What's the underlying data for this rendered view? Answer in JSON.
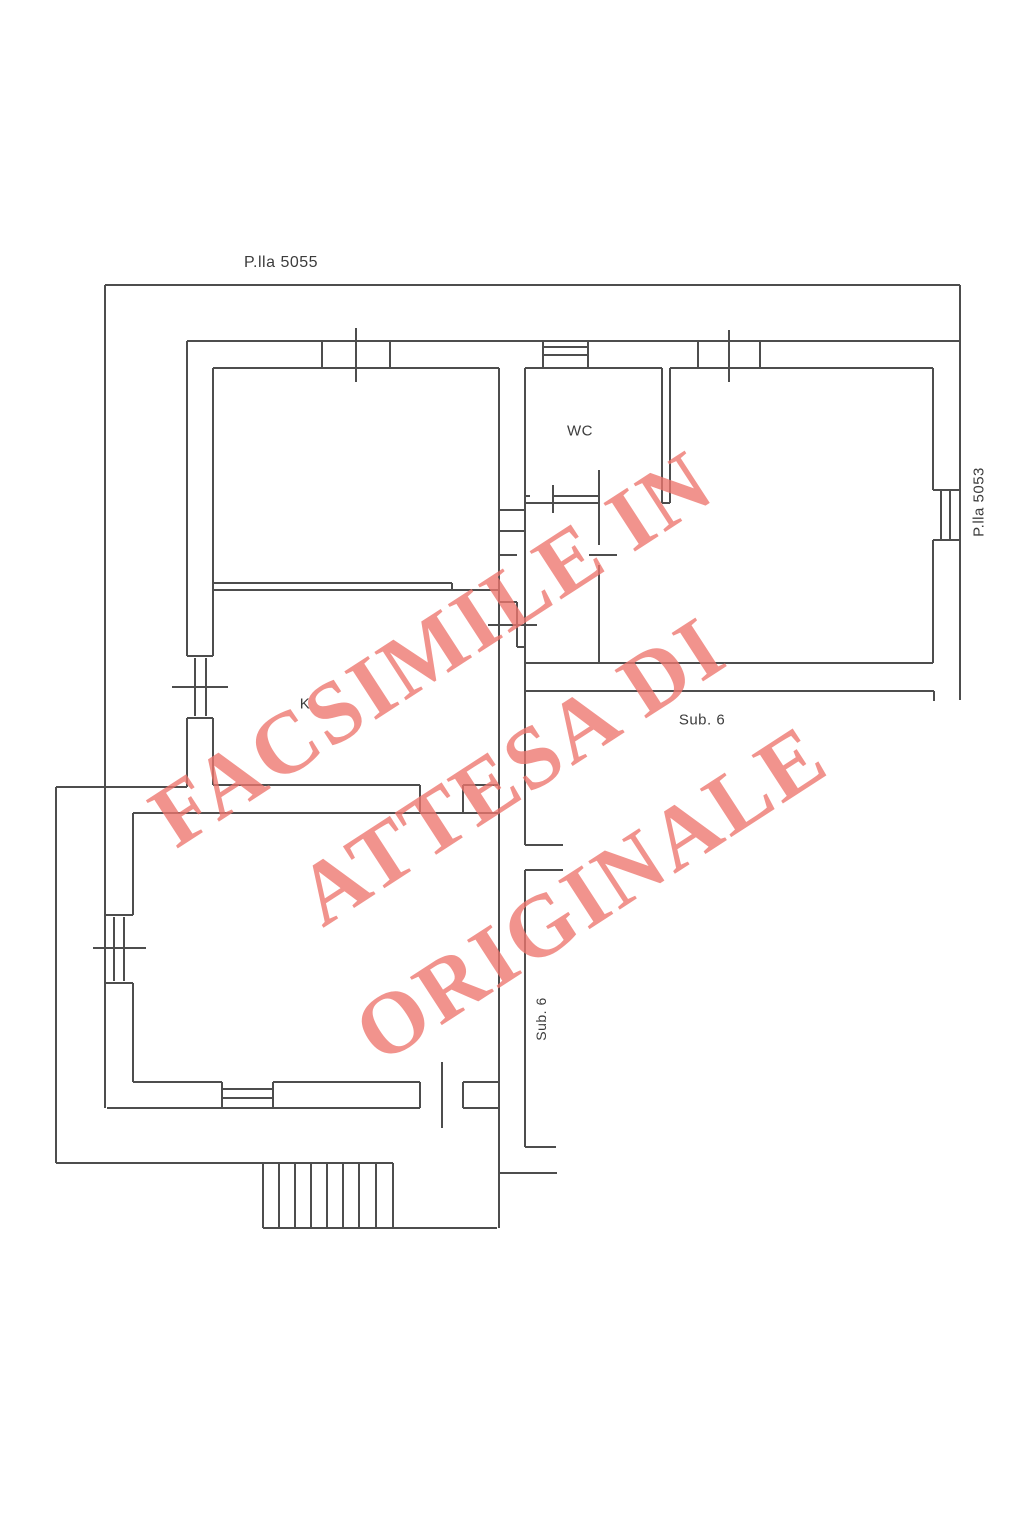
{
  "page": {
    "width": 1023,
    "height": 1535,
    "background": "#ffffff"
  },
  "plan": {
    "stroke": "#4d4d4d",
    "stroke_width": 2,
    "labels": [
      {
        "id": "parcel-label-5055",
        "text": "P.lla 5055",
        "cx": 281,
        "cy": 263,
        "size": 16,
        "rot": 0
      },
      {
        "id": "parcel-label-5053",
        "text": "P.lla 5053",
        "cx": 979,
        "cy": 502,
        "size": 15,
        "rot": -90
      },
      {
        "id": "room-label-wc",
        "text": "WC",
        "cx": 580,
        "cy": 431,
        "size": 15,
        "rot": 0
      },
      {
        "id": "room-label-k",
        "text": "K",
        "cx": 305,
        "cy": 704,
        "size": 15,
        "rot": 0
      },
      {
        "id": "area-label-sub6",
        "text": "Sub. 6",
        "cx": 702,
        "cy": 720,
        "size": 15,
        "rot": 0
      },
      {
        "id": "area-label-sub6-vertical",
        "text": "Sub. 6",
        "cx": 541,
        "cy": 1019,
        "size": 14,
        "rot": -90
      }
    ],
    "segments": [
      [
        105,
        285,
        960,
        285
      ],
      [
        960,
        285,
        960,
        700
      ],
      [
        105,
        285,
        105,
        1108
      ],
      [
        56,
        787,
        187,
        787
      ],
      [
        56,
        787,
        56,
        1163
      ],
      [
        56,
        1163,
        393,
        1163
      ],
      [
        107,
        1108,
        420,
        1108
      ],
      [
        463,
        1108,
        499,
        1108
      ],
      [
        187,
        341,
        960,
        341
      ],
      [
        322,
        341,
        322,
        368
      ],
      [
        390,
        341,
        390,
        368
      ],
      [
        356,
        328,
        356,
        382
      ],
      [
        543,
        341,
        543,
        368
      ],
      [
        588,
        341,
        588,
        368
      ],
      [
        543,
        347,
        588,
        347
      ],
      [
        543,
        355,
        588,
        355
      ],
      [
        698,
        341,
        698,
        368
      ],
      [
        760,
        341,
        760,
        368
      ],
      [
        729,
        330,
        729,
        382
      ],
      [
        187,
        341,
        187,
        656
      ],
      [
        187,
        718,
        187,
        787
      ],
      [
        187,
        656,
        213,
        656
      ],
      [
        187,
        718,
        213,
        718
      ],
      [
        195,
        658,
        195,
        716
      ],
      [
        206,
        658,
        206,
        716
      ],
      [
        172,
        687,
        228,
        687
      ],
      [
        213,
        368,
        499,
        368
      ],
      [
        525,
        368,
        662,
        368
      ],
      [
        670,
        368,
        933,
        368
      ],
      [
        213,
        368,
        213,
        656
      ],
      [
        213,
        718,
        213,
        785
      ],
      [
        213,
        583,
        452,
        583
      ],
      [
        213,
        590,
        499,
        590
      ],
      [
        452,
        583,
        452,
        590
      ],
      [
        499,
        368,
        499,
        1228
      ],
      [
        525,
        368,
        525,
        845
      ],
      [
        525,
        870,
        525,
        1147
      ],
      [
        553,
        496,
        598,
        496
      ],
      [
        525,
        503,
        598,
        503
      ],
      [
        525,
        496,
        530,
        496
      ],
      [
        553,
        485,
        553,
        513
      ],
      [
        662,
        368,
        662,
        503
      ],
      [
        670,
        368,
        670,
        503
      ],
      [
        662,
        503,
        670,
        503
      ],
      [
        599,
        470,
        599,
        545
      ],
      [
        599,
        565,
        599,
        663
      ],
      [
        589,
        555,
        617,
        555
      ],
      [
        525,
        663,
        933,
        663
      ],
      [
        933,
        368,
        933,
        490
      ],
      [
        933,
        540,
        933,
        663
      ],
      [
        933,
        490,
        961,
        490
      ],
      [
        933,
        540,
        961,
        540
      ],
      [
        941,
        490,
        941,
        540
      ],
      [
        950,
        490,
        950,
        540
      ],
      [
        525,
        691,
        934,
        691
      ],
      [
        934,
        691,
        934,
        701
      ],
      [
        525,
        845,
        563,
        845
      ],
      [
        525,
        870,
        563,
        870
      ],
      [
        525,
        1147,
        556,
        1147
      ],
      [
        499,
        510,
        525,
        510
      ],
      [
        499,
        531,
        525,
        531
      ],
      [
        499,
        555,
        517,
        555
      ],
      [
        499,
        602,
        517,
        602
      ],
      [
        517,
        602,
        517,
        647
      ],
      [
        517,
        647,
        525,
        647
      ],
      [
        488,
        625,
        537,
        625
      ],
      [
        213,
        785,
        420,
        785
      ],
      [
        463,
        785,
        499,
        785
      ],
      [
        420,
        785,
        420,
        813
      ],
      [
        463,
        785,
        463,
        813
      ],
      [
        133,
        813,
        499,
        813
      ],
      [
        133,
        813,
        133,
        915
      ],
      [
        133,
        983,
        133,
        1082
      ],
      [
        105,
        915,
        133,
        915
      ],
      [
        105,
        983,
        133,
        983
      ],
      [
        114,
        917,
        114,
        981
      ],
      [
        124,
        917,
        124,
        981
      ],
      [
        93,
        948,
        146,
        948
      ],
      [
        133,
        1082,
        222,
        1082
      ],
      [
        273,
        1082,
        420,
        1082
      ],
      [
        463,
        1082,
        499,
        1082
      ],
      [
        222,
        1082,
        222,
        1108
      ],
      [
        273,
        1082,
        273,
        1108
      ],
      [
        222,
        1089,
        273,
        1089
      ],
      [
        222,
        1098,
        273,
        1098
      ],
      [
        420,
        1082,
        420,
        1108
      ],
      [
        463,
        1082,
        463,
        1108
      ],
      [
        442,
        1062,
        442,
        1128
      ],
      [
        263,
        1228,
        497,
        1228
      ],
      [
        263,
        1163,
        263,
        1228
      ],
      [
        279,
        1163,
        279,
        1228
      ],
      [
        295,
        1163,
        295,
        1228
      ],
      [
        311,
        1163,
        311,
        1228
      ],
      [
        327,
        1163,
        327,
        1228
      ],
      [
        343,
        1163,
        343,
        1228
      ],
      [
        359,
        1163,
        359,
        1228
      ],
      [
        376,
        1163,
        376,
        1228
      ],
      [
        393,
        1163,
        393,
        1228
      ],
      [
        499,
        1173,
        557,
        1173
      ]
    ]
  },
  "watermark": {
    "lines": [
      "FACSIMILE IN",
      "ATTESA DI",
      "ORIGINALE"
    ],
    "color": "rgba(237,116,109,0.78)",
    "angle_deg": -33
  }
}
